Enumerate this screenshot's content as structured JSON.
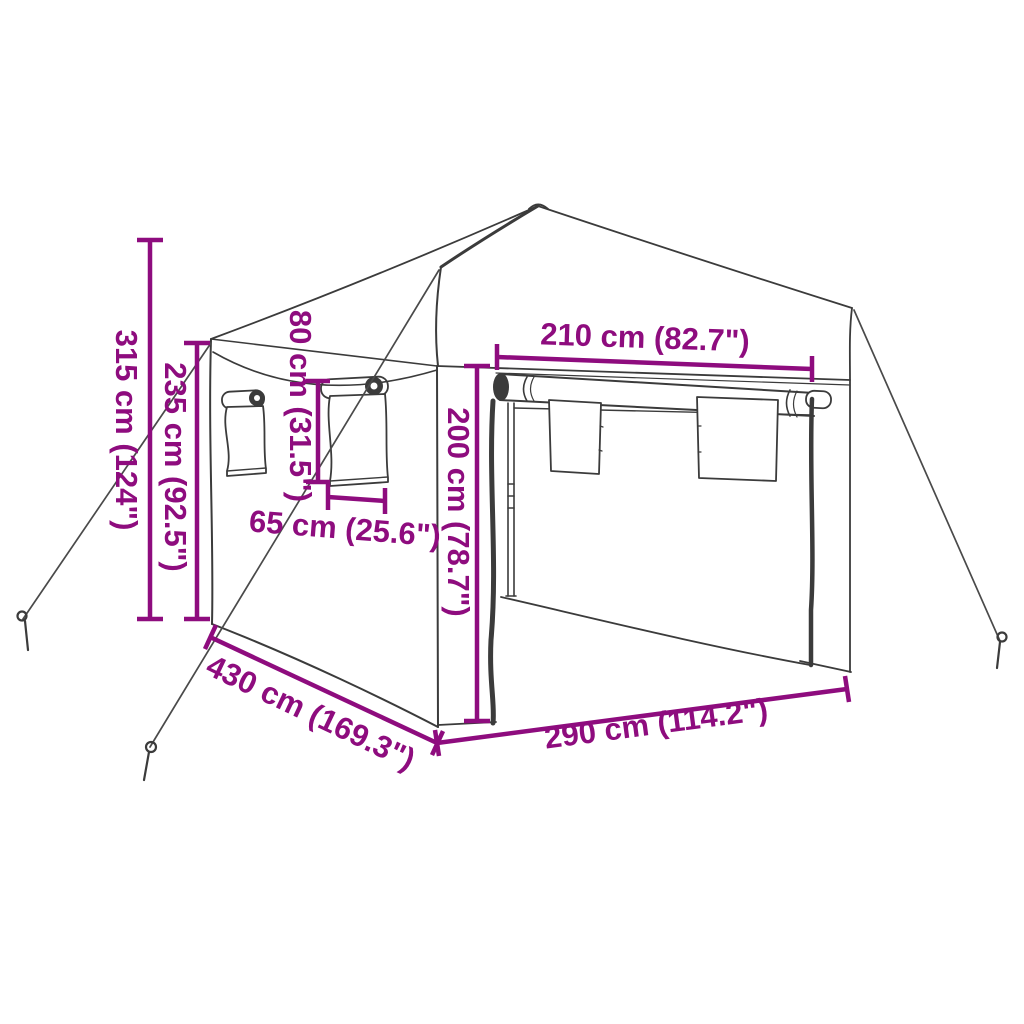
{
  "diagram": {
    "title": "pop-up-party-tent-dimension-diagram",
    "product": "Pop-up party tent with sidewalls, windows and guy ropes",
    "style": {
      "accent_color": "#8e0c7e",
      "line_color": "#3b3b3b",
      "rope_color": "#4a4a4a",
      "background": "#ffffff"
    },
    "dimensions": [
      {
        "id": "total-height",
        "label": "315 cm (124\")",
        "value_cm": "315",
        "value_inch": "124",
        "orientation": "vertical",
        "measures": "total height to roof peak"
      },
      {
        "id": "wall-height",
        "label": "235 cm (92.5\")",
        "value_cm": "235",
        "value_inch": "92.5",
        "orientation": "vertical",
        "measures": "side wall / eave height"
      },
      {
        "id": "window-height",
        "label": "80 cm (31.5\")",
        "value_cm": "80",
        "value_inch": "31.5",
        "orientation": "vertical",
        "measures": "side window height"
      },
      {
        "id": "window-width",
        "label": "65 cm (25.6\")",
        "value_cm": "65",
        "value_inch": "25.6",
        "orientation": "horizontal",
        "measures": "side window width"
      },
      {
        "id": "door-width",
        "label": "210 cm (82.7\")",
        "value_cm": "210",
        "value_inch": "82.7",
        "orientation": "horizontal",
        "measures": "front door opening width"
      },
      {
        "id": "opening-height",
        "label": "200 cm (78.7\")",
        "value_cm": "200",
        "value_inch": "78.7",
        "orientation": "vertical",
        "measures": "front opening height"
      },
      {
        "id": "side-length",
        "label": "430 cm (169.3\")",
        "value_cm": "430",
        "value_inch": "169.3",
        "orientation": "diagonal",
        "measures": "side wall length"
      },
      {
        "id": "front-width",
        "label": "290 cm (114.2\")",
        "value_cm": "290",
        "value_inch": "114.2",
        "orientation": "diagonal",
        "measures": "front width"
      }
    ]
  }
}
